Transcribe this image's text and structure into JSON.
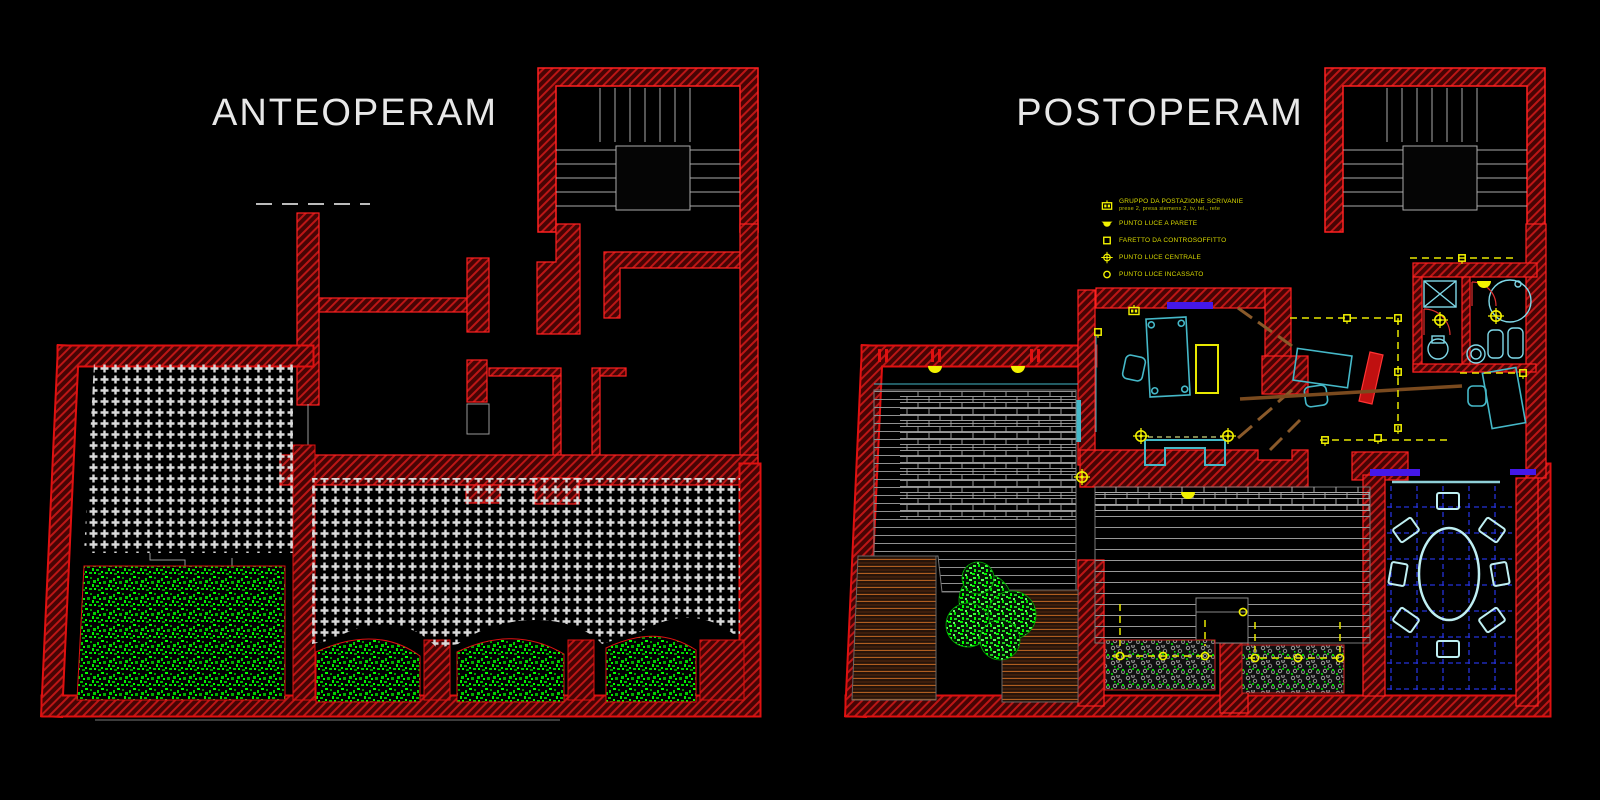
{
  "panels": {
    "left": {
      "title": "ANTEOPERAM"
    },
    "right": {
      "title": "POSTOPERAM"
    }
  },
  "legend": {
    "items": [
      {
        "icon": "desk-outlet-group-icon",
        "label": "GRUPPO DA POSTAZIONE SCRIVANIE",
        "sublabel": "prese 2, presa siemens 2, tv, tel., rete"
      },
      {
        "icon": "wall-light-icon",
        "label": "PUNTO LUCE A PARETE"
      },
      {
        "icon": "ceiling-spotlight-icon",
        "label": "FARETTO DA CONTROSOFFITTO"
      },
      {
        "icon": "central-light-icon",
        "label": "PUNTO LUCE CENTRALE"
      },
      {
        "icon": "recessed-light-icon",
        "label": "PUNTO LUCE INCASSATO"
      }
    ]
  },
  "colors": {
    "background": "#000000",
    "wall_hatch": "#bc1616",
    "wall_edge": "#ff2020",
    "tile_grid": "#dadada",
    "vegetation": "#00cc00",
    "electrical_yellow": "#f2f200",
    "legend_text": "#d8d800",
    "fixture_cyan": "#45b8c8",
    "tile_joint_blue": "#2431d8",
    "window_purple": "#4418e8",
    "wood_brown": "#b05e20",
    "stair_gray": "#aaaaaa",
    "title_text": "#e8e8e8"
  }
}
